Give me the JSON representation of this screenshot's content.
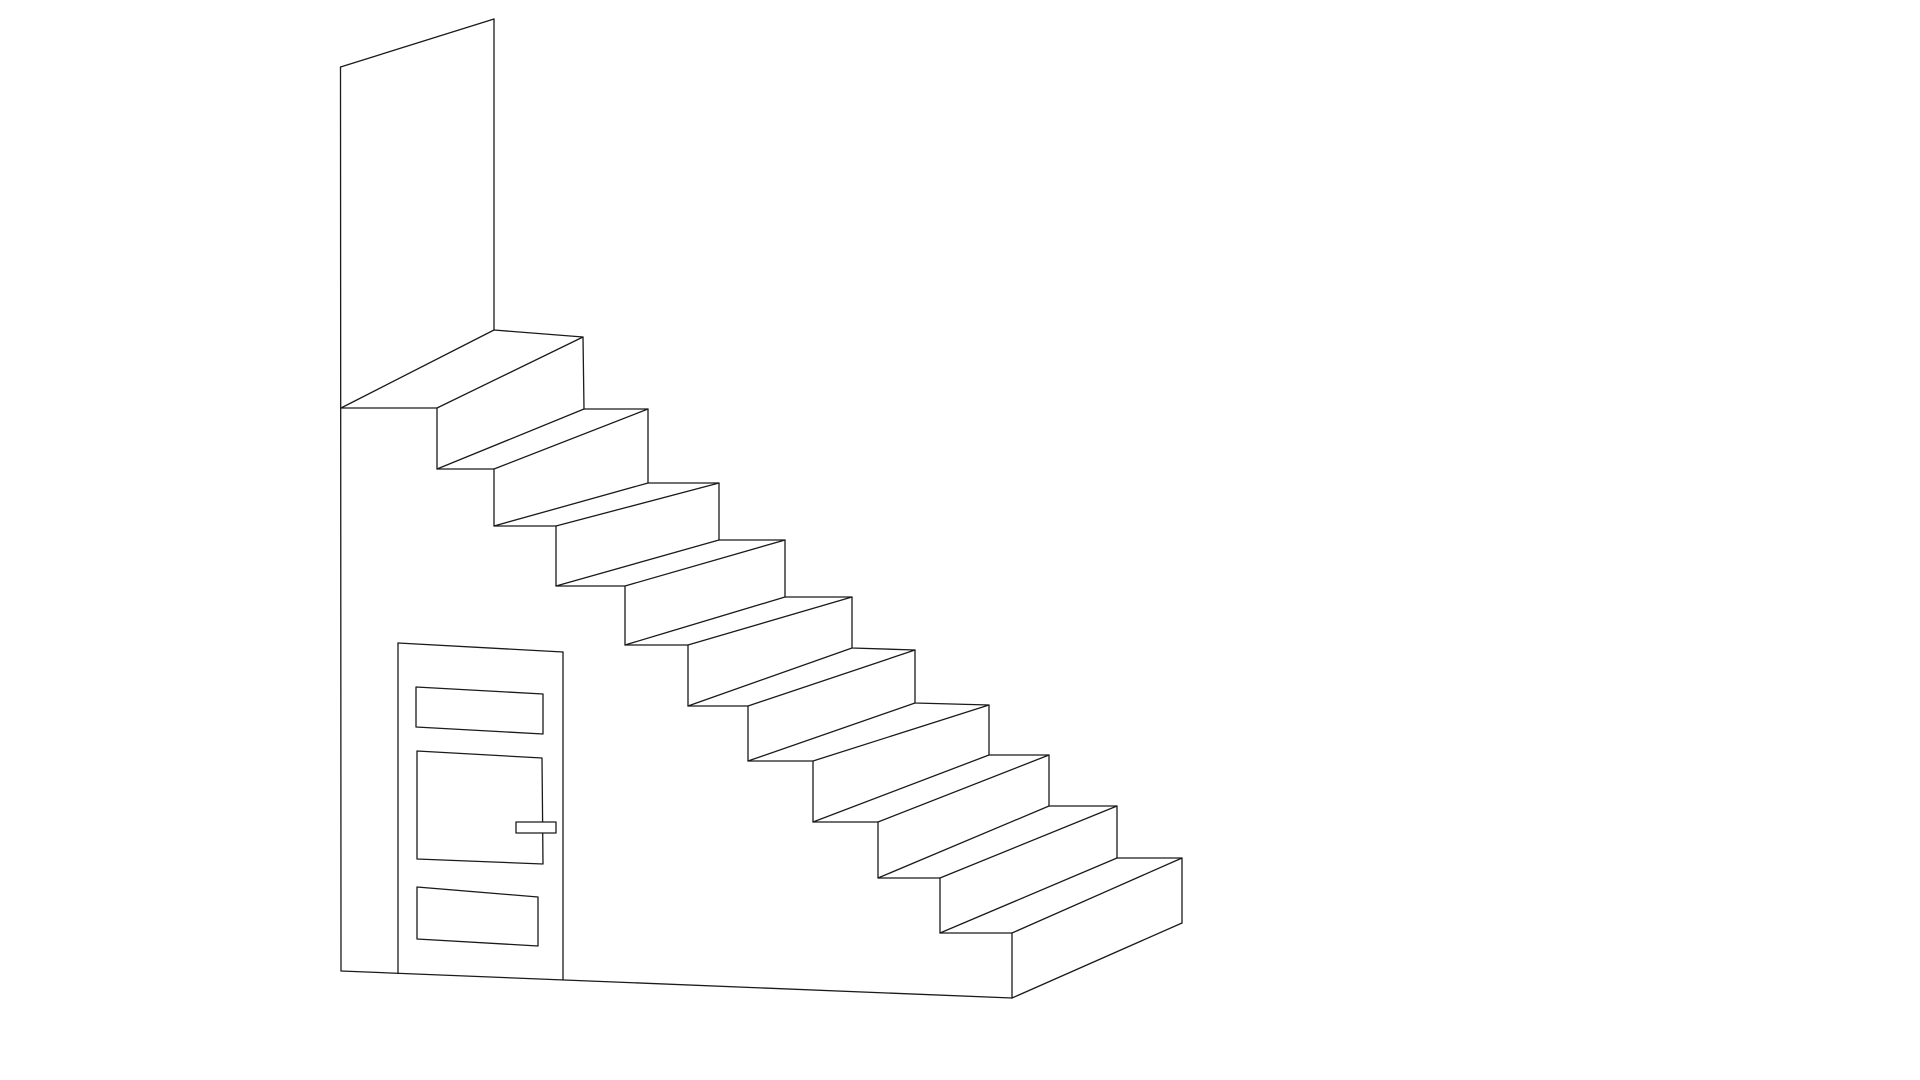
{
  "drawing": {
    "width": 1920,
    "height": 1080,
    "background": "#ffffff",
    "stroke_color": "#1a1a1a",
    "stroke_width": 1.3,
    "description": "Isometric line drawing of a staircase with a tall wall at the top landing and a door under the stairs",
    "polylines": [
      {
        "name": "near-step-silhouette",
        "points": [
          [
            341,
            408
          ],
          [
            437,
            408
          ],
          [
            437,
            469
          ],
          [
            494,
            469
          ],
          [
            494,
            526
          ],
          [
            556,
            526
          ],
          [
            556,
            586
          ],
          [
            625,
            586
          ],
          [
            625,
            645
          ],
          [
            688,
            645
          ],
          [
            688,
            706
          ],
          [
            748,
            706
          ],
          [
            748,
            761
          ],
          [
            813,
            761
          ],
          [
            813,
            822
          ],
          [
            878,
            822
          ],
          [
            878,
            878
          ],
          [
            940,
            878
          ],
          [
            940,
            933
          ],
          [
            1012,
            933
          ],
          [
            1012,
            998
          ]
        ]
      },
      {
        "name": "far-step-silhouette",
        "points": [
          [
            494,
            330
          ],
          [
            583,
            337
          ],
          [
            584,
            409
          ],
          [
            648,
            409
          ],
          [
            648,
            483
          ],
          [
            719,
            483
          ],
          [
            719,
            540
          ],
          [
            785,
            540
          ],
          [
            785,
            597
          ],
          [
            852,
            597
          ],
          [
            852,
            648
          ],
          [
            915,
            650
          ],
          [
            915,
            703
          ],
          [
            989,
            705
          ],
          [
            989,
            755
          ],
          [
            1049,
            755
          ],
          [
            1049,
            806
          ],
          [
            1117,
            806
          ],
          [
            1117,
            858
          ],
          [
            1182,
            858
          ],
          [
            1182,
            923
          ]
        ]
      }
    ],
    "segments": [
      {
        "name": "wall-left-edge",
        "x1": 340.5,
        "y1": 67,
        "x2": 341,
        "y2": 971
      },
      {
        "name": "wall-top-edge",
        "x1": 340.5,
        "y1": 67,
        "x2": 494,
        "y2": 19
      },
      {
        "name": "wall-right-edge",
        "x1": 494,
        "y1": 19,
        "x2": 494,
        "y2": 330
      },
      {
        "name": "floor-edge",
        "x1": 341,
        "y1": 971,
        "x2": 1012,
        "y2": 998
      },
      {
        "name": "door-left-edge",
        "x1": 398,
        "y1": 643,
        "x2": 398,
        "y2": 973.5
      },
      {
        "name": "door-top-edge",
        "x1": 398,
        "y1": 643,
        "x2": 563,
        "y2": 652
      },
      {
        "name": "door-right-edge",
        "x1": 563,
        "y1": 652,
        "x2": 563,
        "y2": 980
      }
    ],
    "depth_lines": [
      [
        341,
        408,
        494,
        330
      ],
      [
        437,
        408,
        583,
        337
      ],
      [
        437,
        469,
        584,
        409
      ],
      [
        494,
        469,
        648,
        409
      ],
      [
        494,
        526,
        648,
        483
      ],
      [
        556,
        526,
        719,
        483
      ],
      [
        556,
        586,
        719,
        540
      ],
      [
        625,
        586,
        785,
        540
      ],
      [
        625,
        645,
        785,
        597
      ],
      [
        688,
        645,
        852,
        597
      ],
      [
        688,
        706,
        852,
        648
      ],
      [
        748,
        706,
        915,
        650
      ],
      [
        748,
        761,
        915,
        703
      ],
      [
        813,
        761,
        989,
        705
      ],
      [
        813,
        822,
        989,
        755
      ],
      [
        878,
        822,
        1049,
        755
      ],
      [
        878,
        878,
        1049,
        806
      ],
      [
        940,
        878,
        1117,
        806
      ],
      [
        940,
        933,
        1117,
        858
      ],
      [
        1012,
        933,
        1182,
        858
      ],
      [
        1012,
        998,
        1182,
        923
      ]
    ],
    "polygons": [
      {
        "name": "door-panel-top",
        "fill": "#ffffff",
        "points": [
          [
            416,
            687
          ],
          [
            543,
            694
          ],
          [
            543,
            734
          ],
          [
            416,
            727
          ]
        ]
      },
      {
        "name": "door-panel-middle",
        "fill": "#ffffff",
        "points": [
          [
            417,
            751
          ],
          [
            542,
            758
          ],
          [
            543,
            864
          ],
          [
            417,
            859
          ]
        ]
      },
      {
        "name": "door-panel-bottom",
        "fill": "#ffffff",
        "points": [
          [
            417,
            887
          ],
          [
            538,
            897
          ],
          [
            538,
            946
          ],
          [
            417,
            939
          ]
        ]
      },
      {
        "name": "door-handle",
        "fill": "#ffffff",
        "points": [
          [
            516,
            822
          ],
          [
            556,
            822
          ],
          [
            556,
            833
          ],
          [
            516,
            833
          ]
        ]
      }
    ]
  }
}
